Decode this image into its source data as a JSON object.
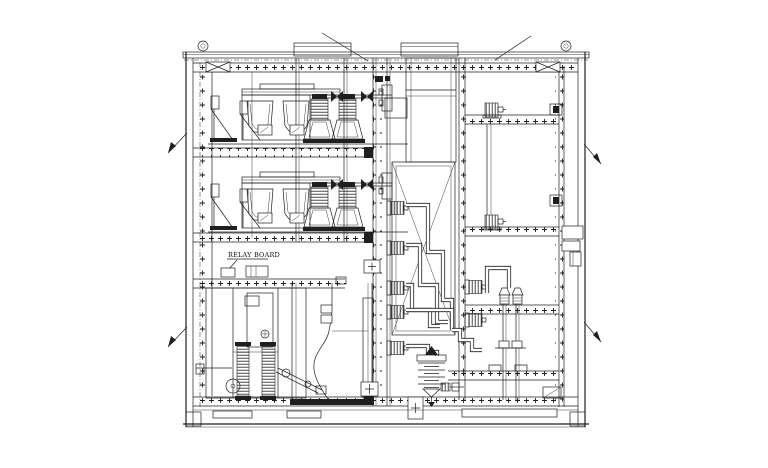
{
  "canvas": {
    "width": 768,
    "height": 468
  },
  "colors": {
    "background": "#ffffff",
    "ink": "#1f1f1f"
  },
  "labels": {
    "relay_board": "RELAY BOARD"
  }
}
